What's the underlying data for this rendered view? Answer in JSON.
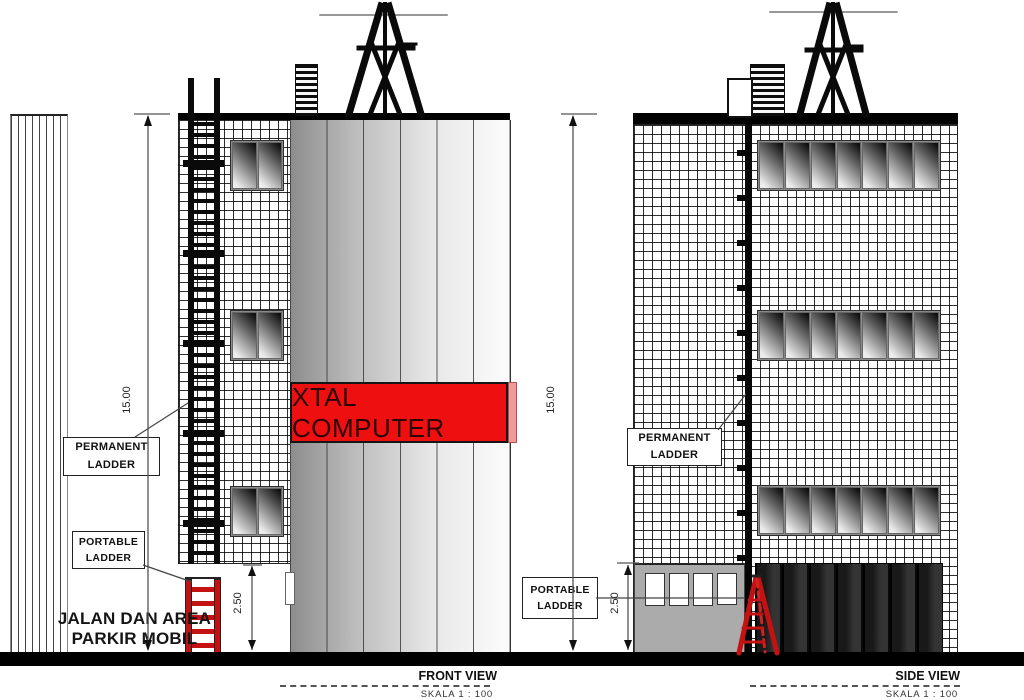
{
  "front_view": {
    "title": "FRONT VIEW",
    "scale_note": "SKALA 1 : 100",
    "banner_text": "XTAL COMPUTER",
    "height_dimension": "15.00",
    "ground_floor_dimension": "2.50",
    "permanent_ladder_label": {
      "line1": "PERMANENT",
      "line2": "LADDER"
    },
    "portable_ladder_label": {
      "line1": "PORTABLE",
      "line2": "LADDER"
    },
    "ground_area_label": {
      "line1": "JALAN DAN AREA",
      "line2": "PARKIR MOBIL"
    }
  },
  "side_view": {
    "title": "SIDE VIEW",
    "scale_note": "SKALA 1 : 100",
    "height_dimension": "15.00",
    "ground_floor_dimension": "2.50",
    "permanent_ladder_label": {
      "line1": "PERMANENT",
      "line2": "LADDER"
    },
    "portable_ladder_label": {
      "line1": "PORTABLE",
      "line2": "LADDER"
    }
  },
  "colors": {
    "banner_red": "#ee1010",
    "ladder_red": "#c41111",
    "annex_gray": "#ababab",
    "storefront_black": "#141414"
  }
}
